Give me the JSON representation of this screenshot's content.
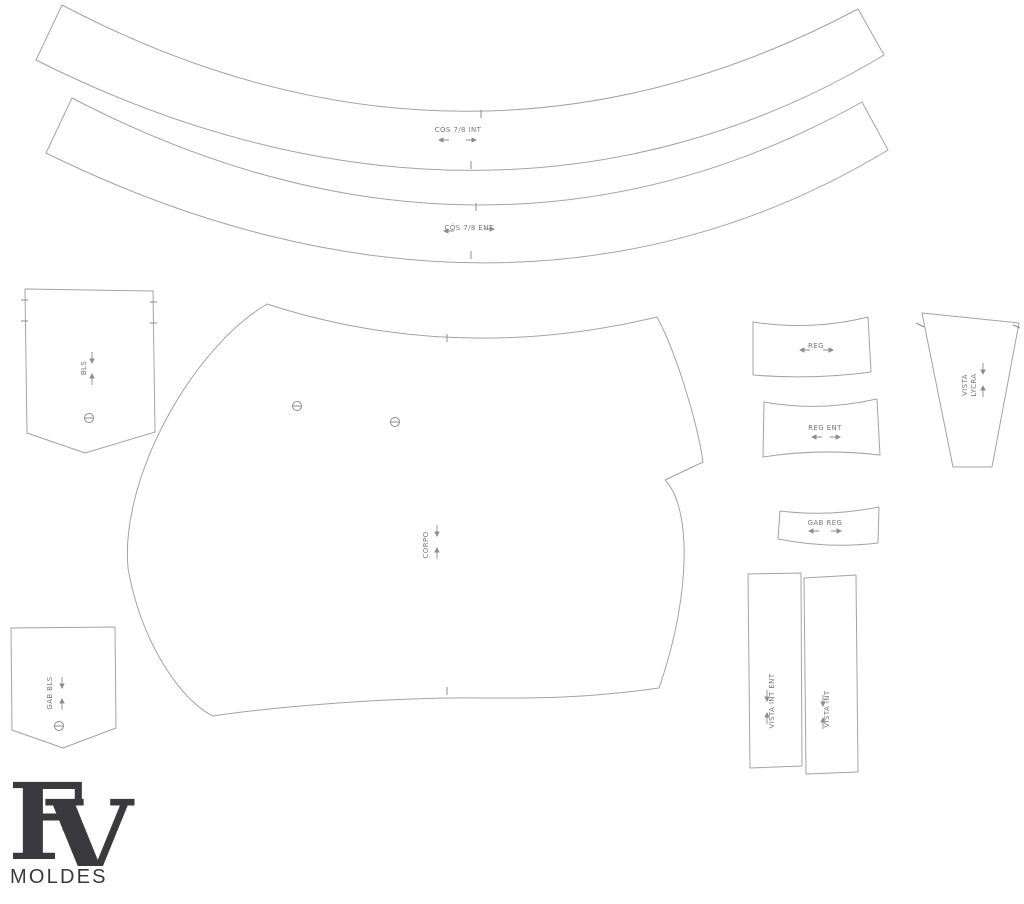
{
  "pieces": {
    "cos_int": {
      "label": "CÓS 7/8 INT"
    },
    "cos_ent": {
      "label": "CÓS 7/8 ENT"
    },
    "bls": {
      "label": "BLS"
    },
    "corpo": {
      "label": "CORPO"
    },
    "gab_bls": {
      "label": "GAB BLS"
    },
    "reg": {
      "label": "REG"
    },
    "reg_ent": {
      "label": "REG ENT"
    },
    "gab_reg": {
      "label": "GAB REG"
    },
    "vista_lycra": {
      "label_line1": "VISTA",
      "label_line2": "LYCRA"
    },
    "vista_int_ent": {
      "label": "VISTA INT ENT"
    },
    "vista_int": {
      "label": "VISTA INT"
    }
  },
  "logo": {
    "monogram_f": "F",
    "monogram_v": "V",
    "wordmark": "MOLDES"
  },
  "colors": {
    "background": "#ffffff",
    "piece_outline": "#a3a3a3",
    "label_text": "#787878",
    "logo": "#3a3a3e"
  }
}
